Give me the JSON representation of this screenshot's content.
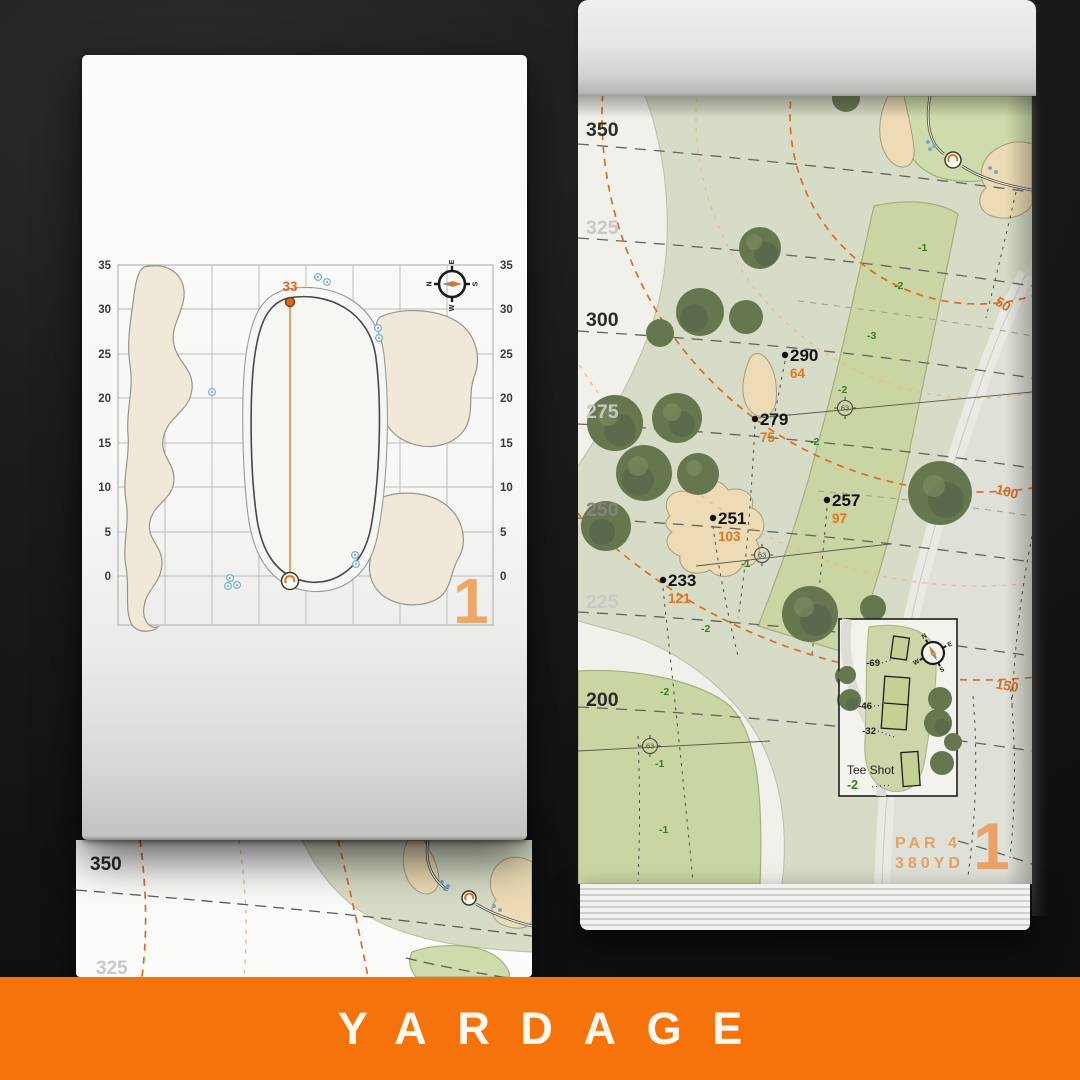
{
  "banner": {
    "title": "YARDAGE"
  },
  "compass": {
    "n": "N",
    "e": "E",
    "s": "S",
    "w": "W"
  },
  "left_page": {
    "hole_number": "1",
    "pin_distance": "33",
    "axis_ticks": [
      "35",
      "30",
      "25",
      "20",
      "15",
      "10",
      "5",
      "0"
    ]
  },
  "under_page": {
    "tick_350": "350",
    "tick_325": "325"
  },
  "right_page": {
    "hole_number": "1",
    "par_label": "PAR 4",
    "yardage_label": "380YD",
    "distance_ticks": [
      "350",
      "325",
      "300",
      "275",
      "250",
      "225",
      "200"
    ],
    "arc_labels": [
      "50",
      "100",
      "150"
    ],
    "sprinkler_label": "63",
    "yardage_points": [
      {
        "dist": "290",
        "remain": "64"
      },
      {
        "dist": "279",
        "remain": "75"
      },
      {
        "dist": "257",
        "remain": "97"
      },
      {
        "dist": "251",
        "remain": "103"
      },
      {
        "dist": "233",
        "remain": "121"
      }
    ],
    "elevations": [
      "-1",
      "-2",
      "-3",
      "-2",
      "-2",
      "-1",
      "-2",
      "-2",
      "-1",
      "-1"
    ],
    "tee_inset": {
      "title": "Tee Shot",
      "elevation": "-2",
      "tee_offsets": [
        "-69",
        "-46",
        "-32"
      ]
    }
  }
}
